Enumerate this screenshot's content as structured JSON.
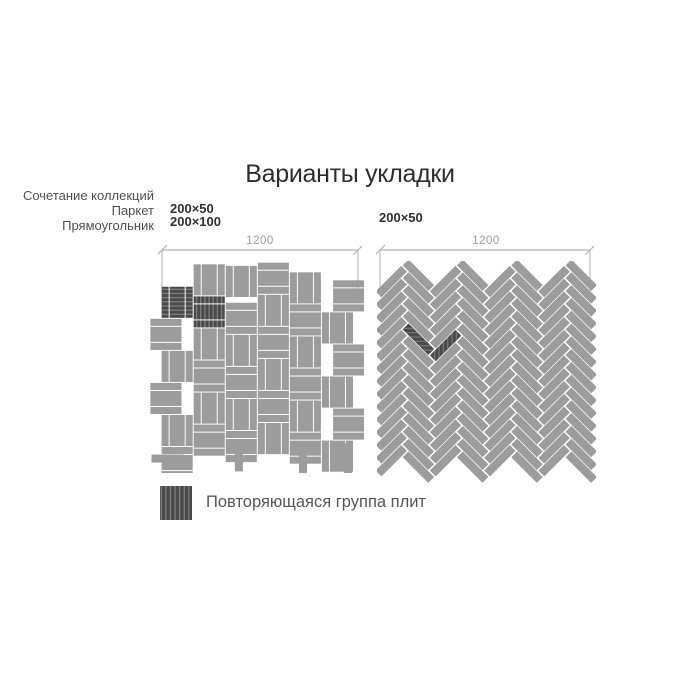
{
  "title": "Варианты укладки",
  "collection_note": {
    "line1": "Сочетание коллекций",
    "line2": "Паркет",
    "line3": "Прямоугольник"
  },
  "left_pattern": {
    "name": "parquet-basketweave",
    "size_label_1": "200×50",
    "size_label_2": "200×100",
    "dimension_label": "1200",
    "dimension_mm": 1200,
    "tile_sizes_mm": [
      "200×50",
      "200×100"
    ],
    "render": {
      "unit_mm": 200,
      "cols": 6,
      "rows": 6,
      "col_offsets_units": [
        0.75,
        1.05,
        0.25,
        0,
        0.3,
        0.55
      ],
      "max_extent_mm": 1360,
      "dark_units": [
        [
          0,
          0
        ],
        [
          1,
          0
        ]
      ],
      "unit_shifts": {
        "0,1": [
          -70,
          0
        ],
        "0,3": [
          -70,
          0
        ],
        "5,0": [
          70,
          0
        ],
        "5,2": [
          70,
          0
        ],
        "5,4": [
          70,
          0
        ],
        "2,0": [
          0,
          -30
        ]
      },
      "extra_units": [
        {
          "x": 200,
          "y": 10,
          "orient": "V"
        }
      ],
      "extra_tiles": [
        {
          "x": 460,
          "y": 1105,
          "w": 50,
          "h": 200
        },
        {
          "x": 860,
          "y": 1120,
          "w": 50,
          "h": 200
        },
        {
          "x": -60,
          "y": 1200,
          "w": 200,
          "h": 50
        },
        {
          "x": 1140,
          "y": 1130,
          "w": 50,
          "h": 200
        }
      ]
    }
  },
  "right_pattern": {
    "name": "herringbone-45",
    "size_label": "200×50",
    "dimension_label": "1200",
    "dimension_mm": 1200,
    "tile_sizes_mm": [
      "200×50"
    ],
    "render": {
      "tile_l": 200,
      "tile_w": 46,
      "v_pitch": 70.7,
      "a_cols": [
        150,
        450,
        750,
        1050
      ],
      "b_cols": [
        0,
        300,
        600,
        900
      ],
      "a_rows": 16,
      "b_rows": 15,
      "dark_tiles": [
        {
          "col": "A",
          "x": 150,
          "row": 5
        },
        {
          "col": "B",
          "x": 300,
          "row": 5
        }
      ]
    }
  },
  "legend": {
    "label": "Повторяющаяся группа плит"
  },
  "colors": {
    "tile": "#9c9c9c",
    "tile_dark": "#4a4a4a",
    "hatch_line": "#7e7e7e",
    "dimension": "#b2b2b2",
    "dimension_text": "#9a9a9a",
    "title_text": "#2d2d2d",
    "note_text": "#4f4f4f",
    "label_text": "#2f2f2f",
    "legend_text": "#555555",
    "background": "#ffffff"
  }
}
